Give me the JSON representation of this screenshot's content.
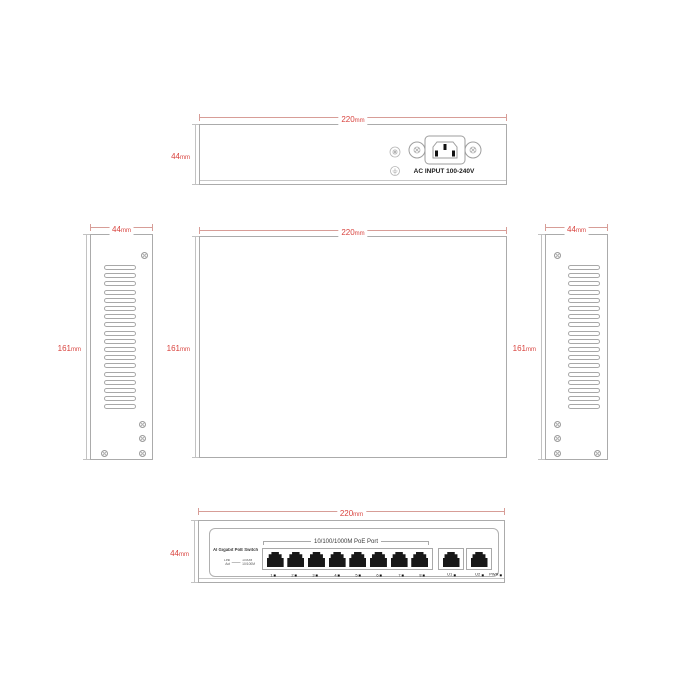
{
  "colors": {
    "dimension_red": "#d9443f",
    "line_gray": "#ababab",
    "port_black": "#181818"
  },
  "views": {
    "back_panel": {
      "width": {
        "value": "220",
        "unit": "mm"
      },
      "height": {
        "value": "44",
        "unit": "mm"
      },
      "ac_input_label": "AC INPUT 100-240V"
    },
    "left_side": {
      "width": {
        "value": "44",
        "unit": "mm"
      },
      "height": {
        "value": "161",
        "unit": "mm"
      }
    },
    "top": {
      "width": {
        "value": "220",
        "unit": "mm"
      },
      "height": {
        "value": "161",
        "unit": "mm"
      }
    },
    "right_side": {
      "width": {
        "value": "44",
        "unit": "mm"
      },
      "height": {
        "value": "161",
        "unit": "mm"
      }
    },
    "front": {
      "width": {
        "value": "220",
        "unit": "mm"
      },
      "height": {
        "value": "44",
        "unit": "mm"
      },
      "device_label": "AI Gigabit PoE Switch",
      "port_group_label": "10/100/1000M PoE Port",
      "poe_port_labels": [
        "1",
        "2",
        "3",
        "4",
        "5",
        "6",
        "7",
        "8"
      ],
      "uplink_port_labels": [
        "U1",
        "U2"
      ],
      "power_led_label": "PWR",
      "led_legend": {
        "left_top": "Link",
        "left_bottom": "Act",
        "right_top": "1000M",
        "right_bottom": "10/100M"
      }
    }
  }
}
